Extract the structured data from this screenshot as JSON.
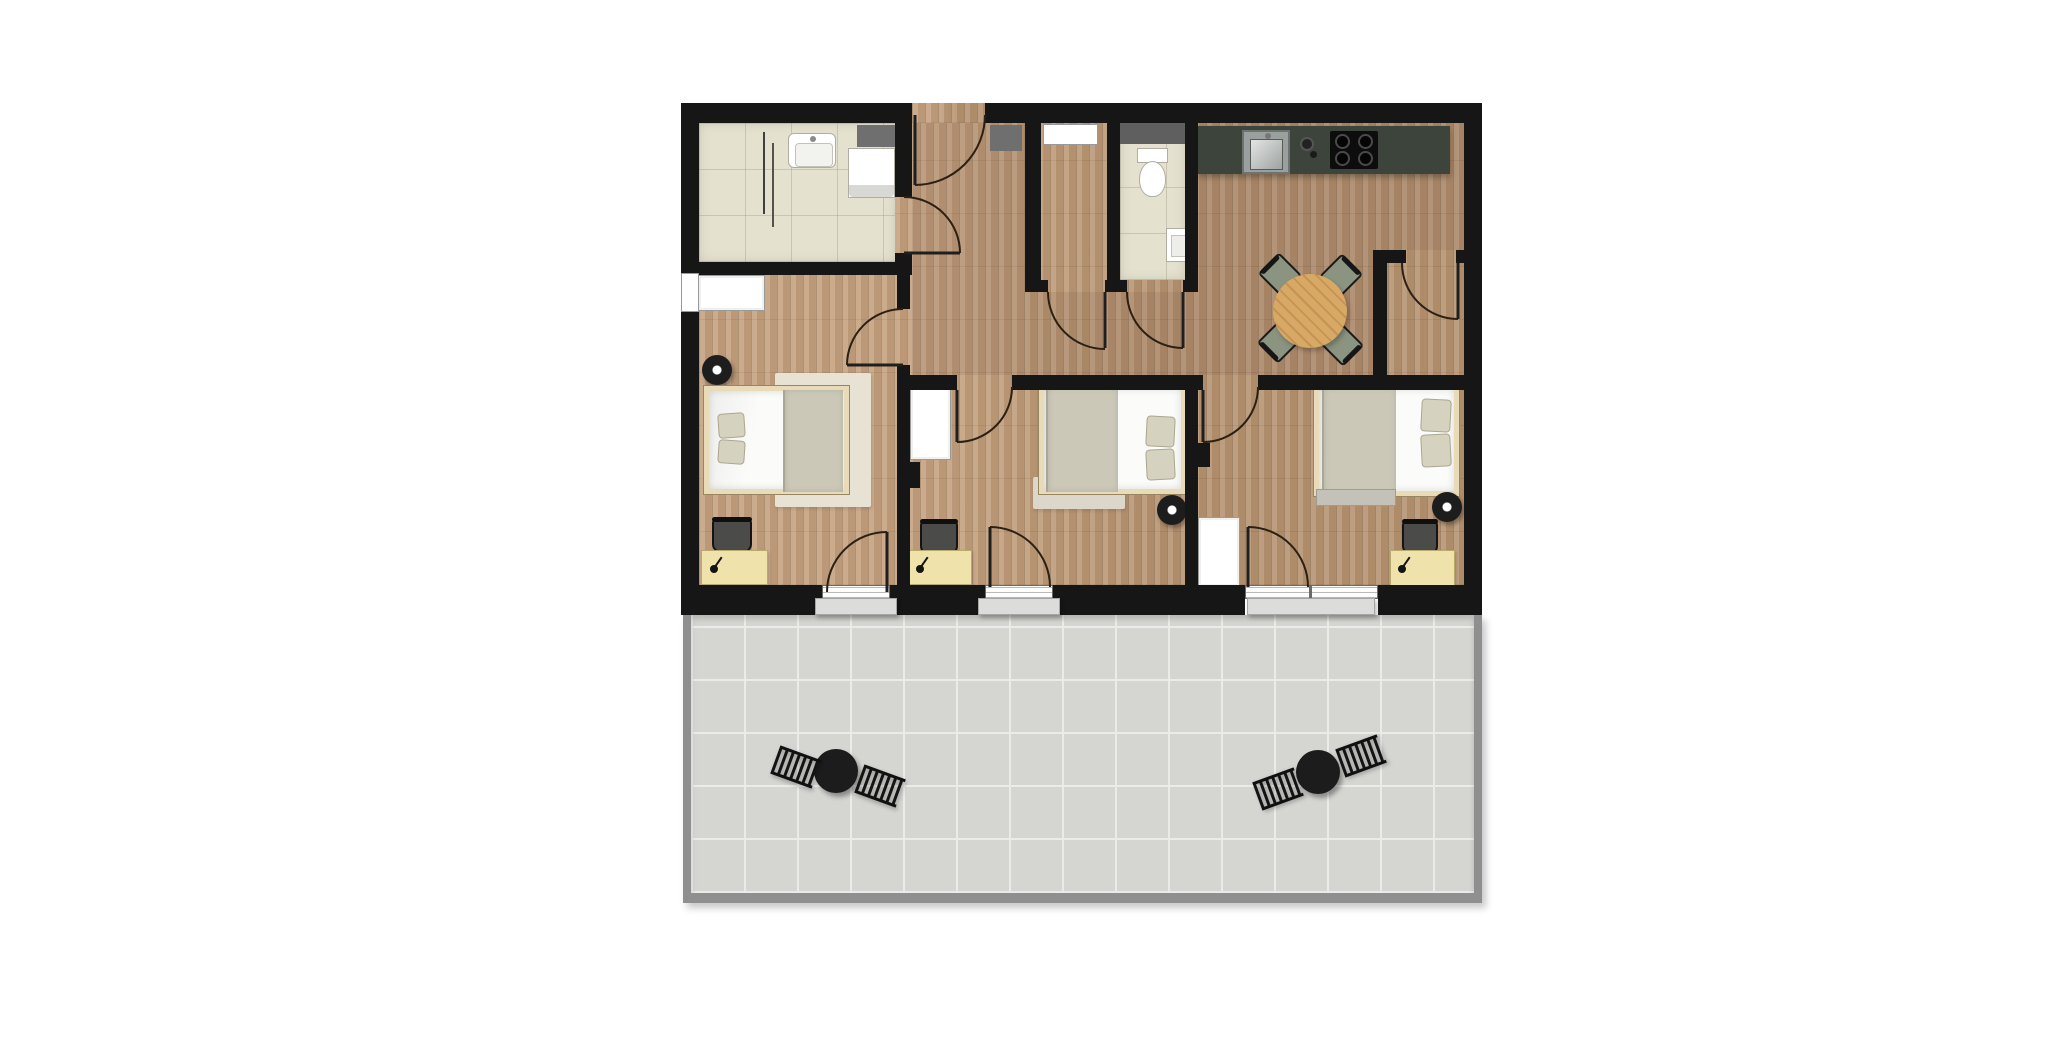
{
  "title": "apartment-floor-plan",
  "colors": {
    "wall": "#161616",
    "wood": "#c29d79",
    "bath_tile": "#e4e1cf",
    "terrace_tile": "#d5d5d2",
    "terrace_line": "#ebebe9",
    "terrace_border": "#8f8f8f",
    "counter": "#3c443c",
    "cooktop": "#0d0d0d",
    "steel": "#b9bfbc",
    "table_wood": "#d8a865",
    "dining_chair": "#8a9480",
    "desk": "#efe2ab",
    "rug": "#e7e2d4",
    "blanket": "#cbc8b8",
    "pillow": "#d6d2c0",
    "bed_frame": "#e9dab8",
    "step": "#dcdcda",
    "vent": "#6f6f6f",
    "arc": "#2b2013",
    "leaf": "#1f1f1f",
    "speaker": "#1d1d1d",
    "desk_chair": "#4b4b49",
    "bench": "#c3c1b8",
    "bistro": "#1c1c1c",
    "tint": "rgba(84,60,45,0.10)"
  },
  "rooms": [
    {
      "name": "bathroom",
      "floor": "beige-tile",
      "furniture": [
        "sink",
        "washing-machine",
        "shower-partition"
      ]
    },
    {
      "name": "hallway",
      "floor": "wood",
      "furniture": []
    },
    {
      "name": "storage-closet-top",
      "floor": "wood",
      "furniture": [
        "window"
      ]
    },
    {
      "name": "wc",
      "floor": "beige-tile",
      "furniture": [
        "toilet",
        "hand-sink"
      ]
    },
    {
      "name": "kitchen-living",
      "floor": "wood",
      "furniture": [
        "counter",
        "kitchen-sink",
        "cooktop",
        "round-dining-table",
        "4-dining-chairs"
      ]
    },
    {
      "name": "storage-closet-entry",
      "floor": "wood",
      "furniture": []
    },
    {
      "name": "bedroom-left",
      "floor": "wood",
      "furniture": [
        "double-bed",
        "rug",
        "wardrobe",
        "desk",
        "desk-chair",
        "desk-lamp",
        "speaker-table"
      ]
    },
    {
      "name": "bedroom-middle",
      "floor": "wood",
      "furniture": [
        "double-bed",
        "wardrobe",
        "desk",
        "desk-chair",
        "desk-lamp",
        "speaker-table"
      ]
    },
    {
      "name": "bedroom-right",
      "floor": "wood",
      "furniture": [
        "double-bed",
        "bench",
        "wardrobe",
        "desk",
        "desk-chair",
        "desk-lamp",
        "speaker-table"
      ]
    },
    {
      "name": "terrace",
      "floor": "gray-tile",
      "furniture": [
        "bistro-set-left",
        "bistro-set-right"
      ]
    }
  ],
  "doors": {
    "hinged": 11,
    "terrace_thresholds": 3,
    "entrance": "top-center"
  },
  "windows": {
    "top_wall": 1,
    "left_wall": 1,
    "vents": 3
  }
}
